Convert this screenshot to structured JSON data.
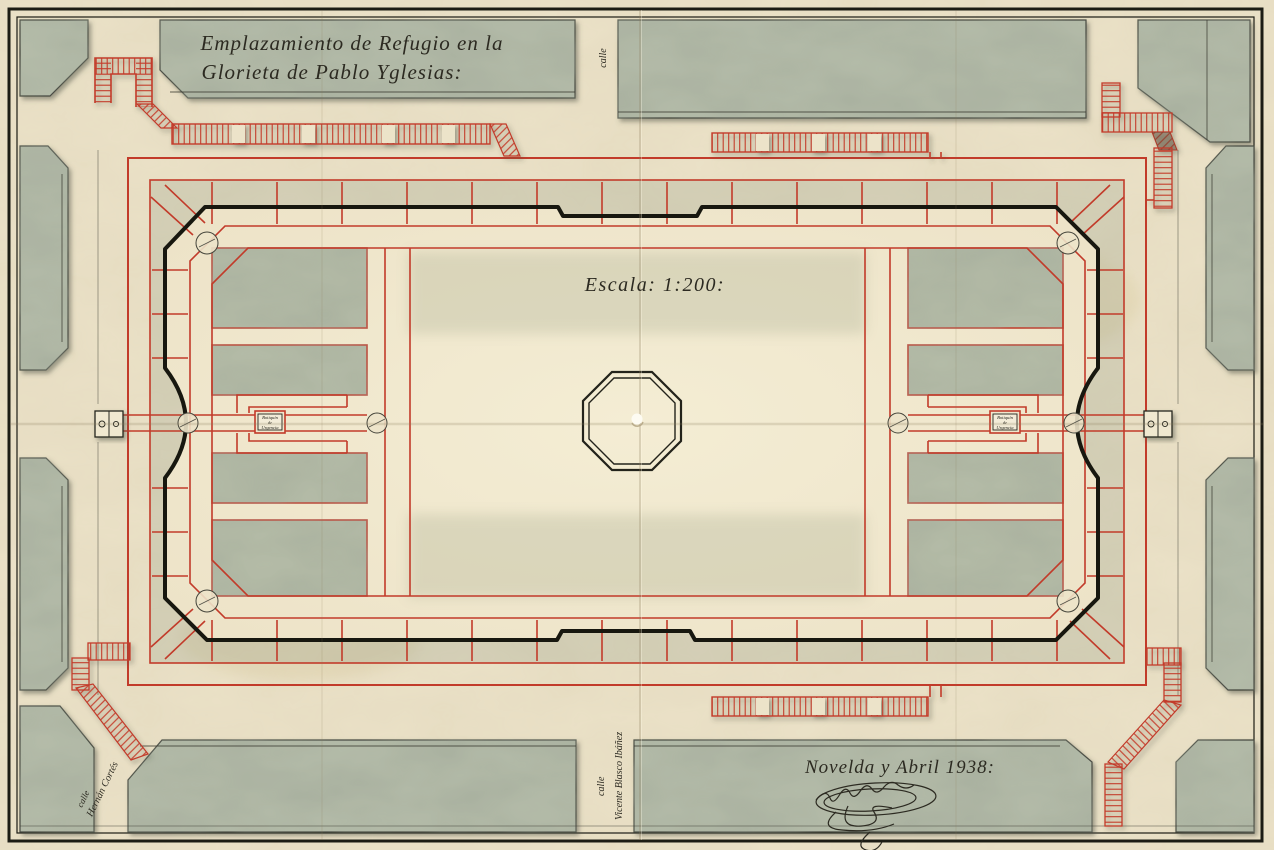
{
  "plan": {
    "title_line1": "Emplazamiento de Refugio en la",
    "title_line2": "Glorieta de Pablo Yglesias:",
    "scale_label": "Escala: 1:200:",
    "footer_date": "Novelda y Abril 1938:"
  },
  "streets": {
    "top": "calle",
    "southwest_line1": "calle",
    "southwest_line2": "Hernán Cortés",
    "south_line1": "calle",
    "south_line2": "Vicente Blasco Ibáñez"
  },
  "aid_station": {
    "line1": "Botiquín",
    "line2": "de",
    "line3": "Urgencia"
  },
  "colors": {
    "paper": "#ebe2c8",
    "plaza_lawn": "#f2ead2",
    "city_block": "#b6bdaa",
    "ink": "#2c2a21",
    "gallery_red": "#c23b2a"
  }
}
